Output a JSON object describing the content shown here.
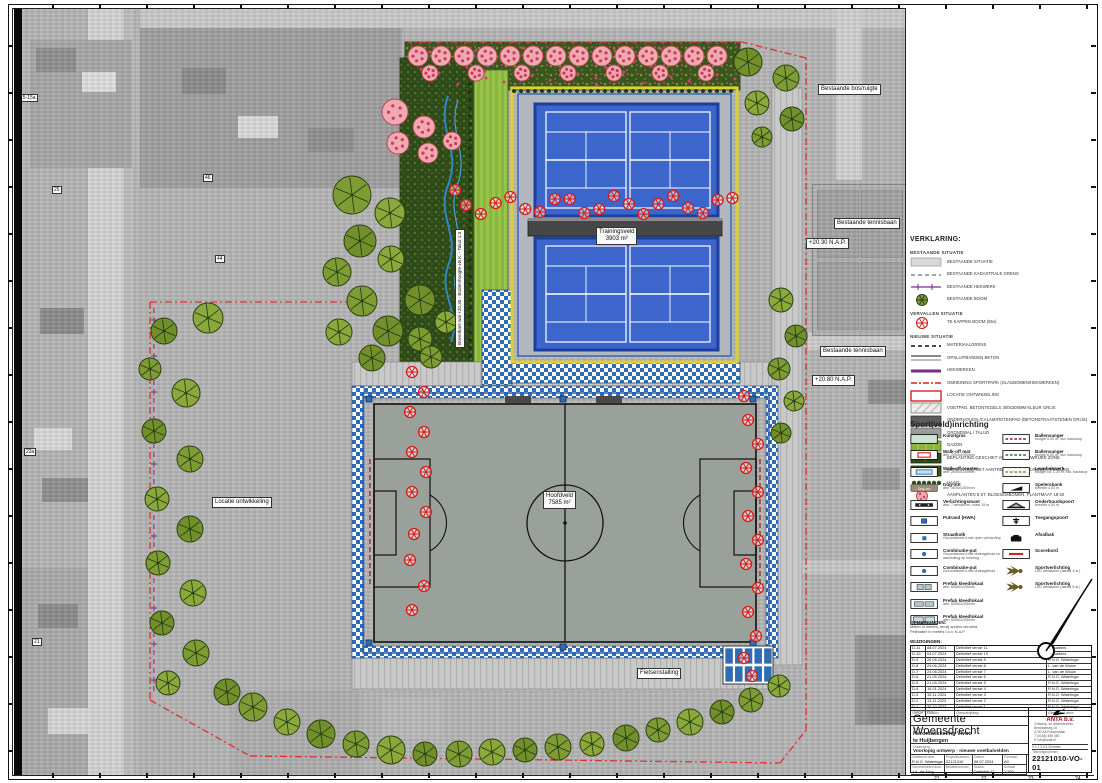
{
  "colors": {
    "accent_yellow": "#ddcf3a",
    "court_blue": "#3c66cc",
    "fence_blue": "#2b5cb8",
    "tree_green": "#7d9c33",
    "tree_red": "#d61c1c",
    "blossom_pink": "#efa7b0",
    "boundary_red": "#e03030",
    "purple": "#7b2d8e",
    "checker_blue": "#2e6db4"
  },
  "icons": {
    "north_arrow": "north-arrow-icon",
    "company_logo": "bird-logo-icon"
  },
  "map_labels": {
    "bestaande_bos": "Bestaande bos/ruigte",
    "tennis1": "Bestaande tennisbaan",
    "nap1": "+20.30 N.A.P.",
    "tennis2": "Bestaande tennisbaan",
    "nap2": "+20.80 N.A.P.",
    "trainingsveld": "Trainingsveld",
    "trainingsveld_area": "3903 m²",
    "hoofdveld": "Hoofdveld",
    "hoofdveld_area": "7585 m²",
    "fietsenstalling": "Fietsenstalling",
    "locatie": "Locatie ontwikkeling",
    "wal": "Bovenkant wal +20.30  -  Bodemhoogte ±B.K.  -  Talud 1:3",
    "house_numbers": [
      "15-15a",
      "25",
      "46",
      "23a",
      "21",
      "44"
    ]
  },
  "legend": {
    "title": "VERKLARING:",
    "sections": [
      {
        "header": "BESTAANDE SITUATIE",
        "items": [
          {
            "swatch": "gray-fill",
            "label": "BESTAANDE SITUATIE"
          },
          {
            "swatch": "gray-dash",
            "label": "BESTAANDE KADASTRALE GRENS"
          },
          {
            "swatch": "purple-fence",
            "label": "BESTAANDE HEKWERK"
          },
          {
            "swatch": "tree-green",
            "label": "BESTAANDE BOOM"
          }
        ]
      },
      {
        "header": "VERVALLEN SITUATIE",
        "items": [
          {
            "swatch": "tree-red",
            "label": "TE KAPPEN BOOM (65x)"
          }
        ]
      },
      {
        "header": "NIEUWE SITUATIE",
        "items": [
          {
            "swatch": "black-dash",
            "label": "MATERIAALGRENS"
          },
          {
            "swatch": "gray-band",
            "label": "OPSLUITBANDEN BETON"
          },
          {
            "swatch": "purple-solid",
            "label": "HEKWERKEN"
          },
          {
            "swatch": "red-dashdot",
            "label": "OMHEINING SPORTPARK (SLAGBOMEN/HEKWERKEN)"
          },
          {
            "swatch": "red-box",
            "label": "LOCATIE ONTWIKKELING"
          },
          {
            "swatch": "hatch-gray",
            "label": "VOETPAD, BETONTEGELS 300x300MM KLEUR GRIJS"
          },
          {
            "swatch": "dark-gray",
            "label": "ONDERHOUDS-/CALAMITEITENPAD (BETONSTRAATSTENEN GRIJS)"
          },
          {
            "swatch": "mid-gray",
            "label": "GRONDWAL / TALUD"
          },
          {
            "swatch": "gazon",
            "label": "GAZON"
          },
          {
            "swatch": "plant-shadow",
            "label": "BEPLANTING GESCHIKT VOOR SCHADUWRIJKE ZONE"
          },
          {
            "swatch": "plant-vlinder",
            "label": "BEPLANTING MET AANTREKKING VAN VLINDERS EN BIJEN"
          },
          {
            "swatch": "haag",
            "label": "HAAG"
          },
          {
            "swatch": "blossom",
            "label": "AANPLANTEN 8 ST. BLOESEMBOMEN, PLANTMAAT 18-20"
          }
        ]
      }
    ],
    "sport_title": "Sport(veld)inrichting",
    "sport_left": [
      {
        "swatch": "kunstgras",
        "label": "Kunstgras",
        "sub": ""
      },
      {
        "swatch": "walkoff-mat",
        "label": "Walk-off mat",
        "sub": "afm. 2000x1000mm"
      },
      {
        "swatch": "walkoff-rooster",
        "label": "Walk-off rooster",
        "sub": "afm. 2000x1000mm"
      },
      {
        "swatch": "dugout",
        "label": "Dug-out",
        "sub": "afm. 3000x1500mm"
      },
      {
        "swatch": "lichtmast",
        "label": "Verlichtingsmast",
        "sub": "afm. 7 armaturen, mast 15 m"
      },
      {
        "swatch": "putrand",
        "label": "Putrand (HWA)",
        "sub": ""
      },
      {
        "swatch": "straatkolk",
        "label": "Straatkolk",
        "sub": "Gecombineerd met open verharding"
      },
      {
        "swatch": "combiput",
        "label": "Combinatie-put",
        "sub": "Gecombineerd met drainagebuis en aansluiting op riolering"
      },
      {
        "swatch": "combiput",
        "label": "Combinatie-put",
        "sub": "Gecombineerd met drainagebuis"
      },
      {
        "swatch": "prefab1",
        "label": "Prefab kleedlokaal",
        "sub": "afm. 6055x2435mm"
      },
      {
        "swatch": "prefab2",
        "label": "Prefab kleedlokaal",
        "sub": "afm. 6055x2435mm"
      },
      {
        "swatch": "prefab3",
        "label": "Prefab kleedlokaal",
        "sub": "afm. 6055x2435mm"
      }
    ],
    "sport_right": [
      {
        "swatch": "ballenvanger-rood",
        "label": "Ballenvanger",
        "sub": "hoogte 5.00 m, incl. backstop"
      },
      {
        "swatch": "ballenvanger-groen",
        "label": "Ballenvanger",
        "sub": "hoogte 6.00 m, incl. backstop"
      },
      {
        "swatch": "leunhek",
        "label": "Leunhekwerk",
        "sub": "hoogte ca. 1.20 m, incl. backstop"
      },
      {
        "swatch": "spelersbank",
        "label": "Spelersbank",
        "sub": "breedte 3.00 m"
      },
      {
        "swatch": "onderhoudspoort",
        "label": "Onderhoudspoort",
        "sub": "breedte 4.00 m"
      },
      {
        "swatch": "toegangspoort",
        "label": "Toegangspoort",
        "sub": ""
      },
      {
        "swatch": "afvalbak",
        "label": "Afvalbak",
        "sub": ""
      },
      {
        "swatch": "scorebord",
        "label": "Scorebord",
        "sub": ""
      },
      {
        "swatch": "sportverlichting",
        "label": "Sportverlichting",
        "sub": "LED armaturen (aantal 4 st.)"
      },
      {
        "swatch": "sportverlichting",
        "label": "Sportverlichting",
        "sub": "LED armaturen (aantal 6 st.)"
      }
    ]
  },
  "opmerkingen": {
    "title": "OPMERKINGEN:",
    "lines": [
      "Maten in meters, tenzij anders vermeld.",
      "Peilmaten in meters t.o.v. N.A.P."
    ]
  },
  "revisions": {
    "header_label": "WIJZIGINGEN:",
    "columns": [
      "Versie",
      "Datum",
      "Omschrijving",
      "Getekend door"
    ],
    "rows": [
      [
        "D-11",
        "08.07.2024",
        "Definitief versie 11",
        "M. Aalbers"
      ],
      [
        "D-10",
        "04.07.2024",
        "Definitief versie 10",
        "M. Aalbers"
      ],
      [
        "D-9",
        "26.06.2024",
        "Definitief versie 9",
        "R.N.O. Wateringa"
      ],
      [
        "D-8",
        "24.06.2024",
        "Definitief versie 8",
        "L. van de Wouw"
      ],
      [
        "D-7",
        "24.06.2024",
        "Definitief versie 7",
        "L. van de Wouw"
      ],
      [
        "D-6",
        "21.05.2024",
        "Definitief versie 6",
        "R.N.O. Wateringa"
      ],
      [
        "D-5",
        "21.05.2024",
        "Definitief versie 5",
        "R.N.O. Wateringa"
      ],
      [
        "D-4",
        "16.01.2024",
        "Definitief versie 4",
        "R.N.O. Wateringa"
      ],
      [
        "D-3",
        "15.11.2023",
        "Definitief versie 3",
        "R.N.O. Wateringa"
      ],
      [
        "D-2",
        "13.11.2023",
        "Definitief versie 2",
        "R.N.O. Wateringa"
      ],
      [
        "D-1",
        "26.10.2023",
        "Definitief versie 1",
        "R.N.O. Wateringa"
      ]
    ]
  },
  "title_block": {
    "client_label": "Opdrachtgever:",
    "client": "Gemeente Woensdrecht",
    "project_label": "Project:",
    "project_line1": "Herontwikkeling Vivoo",
    "project_line2": "te Huijbergen",
    "subject_label": "Onderwerp:",
    "subject": "Voorlopig ontwerp - nieuwe voetbalvelden",
    "fields": [
      {
        "label": "Getekend door:",
        "value": "R.N.O. Wateringa"
      },
      {
        "label": "Projectnummer:",
        "value": "22121010"
      },
      {
        "label": "Datum:",
        "value": "08.07.2024"
      },
      {
        "label": "Formaat:",
        "value": "A0"
      },
      {
        "label": "Gecontroleerd door:",
        "value": "J.A. de Jong"
      },
      {
        "label": "Besteknummer:",
        "value": "—"
      },
      {
        "label": "Status:",
        "value": "Definitief-11"
      },
      {
        "label": "Schaal:",
        "value": "1:250"
      }
    ],
    "drawing_number_label": "Tekeningnummer:",
    "drawing_number": "22121010-VO-01",
    "scalebar": "0  1  2  3  4  5          10 meter",
    "company": {
      "name": "ANTA b.v.",
      "lines": [
        "Ontwerp- en adviesbureau",
        "Bredaseweg 10",
        "4700 AA  Roosendaal",
        "T (0165) 450 450",
        "E info@anta.nl"
      ]
    }
  },
  "sheet": {
    "bottom_ticks": [
      "21",
      "22",
      "23",
      "24"
    ]
  }
}
